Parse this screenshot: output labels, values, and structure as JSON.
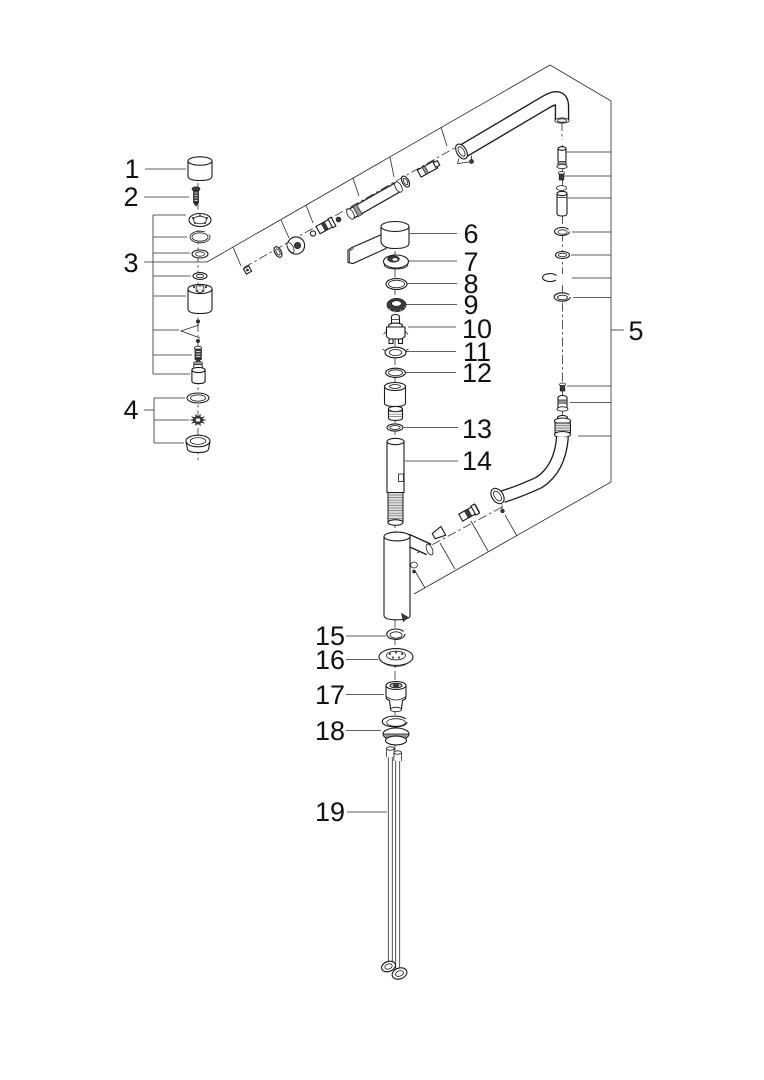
{
  "figure": {
    "kind": "exploded-view parts diagram",
    "background_color": "#ffffff",
    "line_color": "#1a1a1a",
    "dark_part_color": "#3c3c3c"
  },
  "labels": [
    {
      "num": "1"
    },
    {
      "num": "2"
    },
    {
      "num": "3"
    },
    {
      "num": "4"
    },
    {
      "num": "5"
    },
    {
      "num": "6"
    },
    {
      "num": "7"
    },
    {
      "num": "8"
    },
    {
      "num": "9"
    },
    {
      "num": "10"
    },
    {
      "num": "11"
    },
    {
      "num": "12"
    },
    {
      "num": "13"
    },
    {
      "num": "14"
    },
    {
      "num": "15"
    },
    {
      "num": "16"
    },
    {
      "num": "17"
    },
    {
      "num": "18"
    },
    {
      "num": "19"
    }
  ]
}
